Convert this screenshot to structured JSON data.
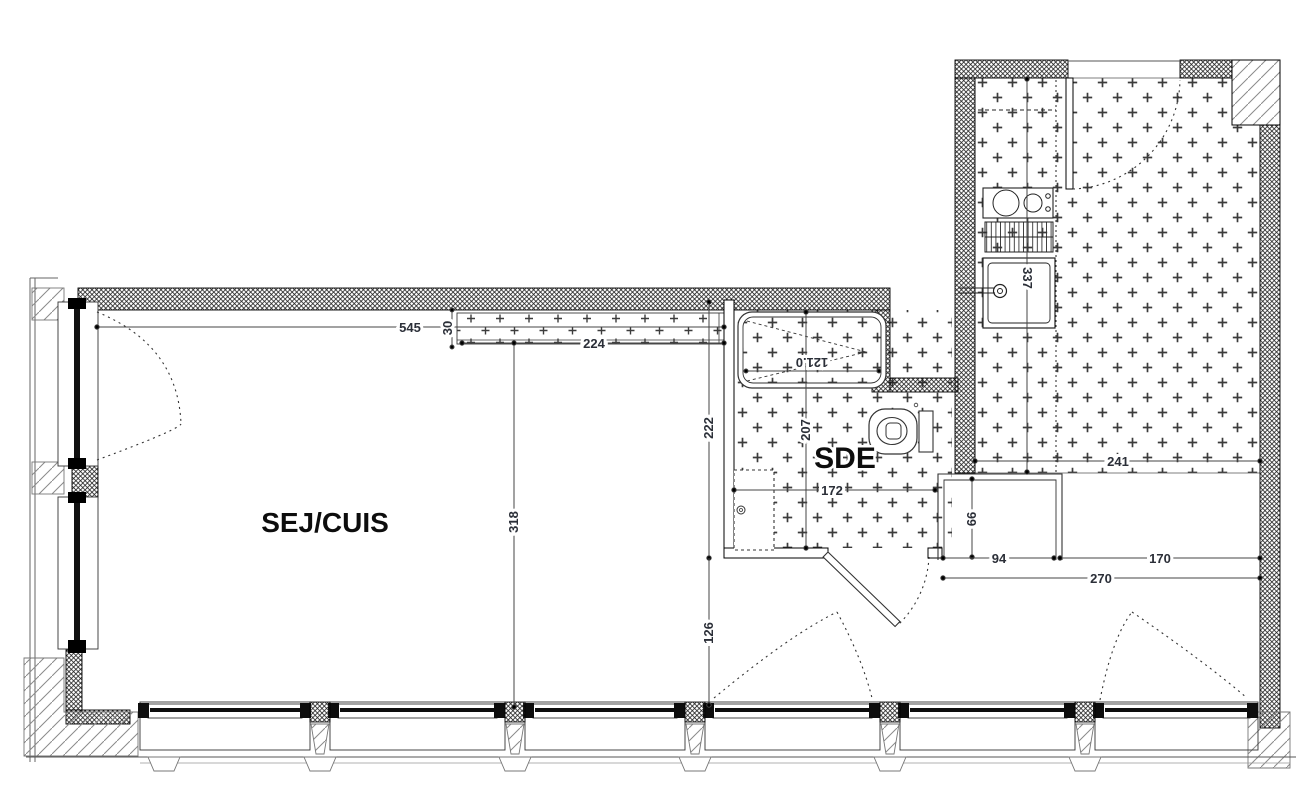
{
  "plan": {
    "rooms": {
      "sej_cuis": "SEJ/CUIS",
      "sde": "SDE"
    },
    "dimensions": {
      "d545": "545",
      "d30": "30",
      "d224": "224",
      "d318": "318",
      "d222": "222",
      "d126": "126",
      "d207": "207",
      "d172": "172",
      "d121": "121.0",
      "d241": "241",
      "d337": "337",
      "d66": "66",
      "d94": "94",
      "d170": "170",
      "d270": "270"
    },
    "colors": {
      "wall_line": "#1a1a1a",
      "dim_line": "#444444",
      "dim_text": "#2b2f38"
    }
  }
}
